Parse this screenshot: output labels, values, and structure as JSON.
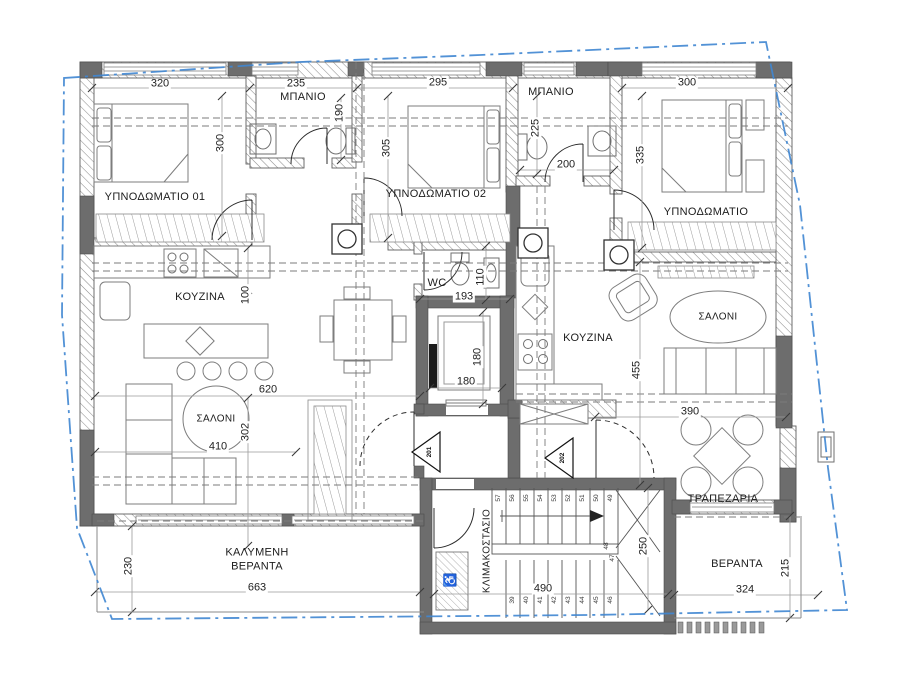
{
  "plan": {
    "rooms": {
      "bedroom1": {
        "label": "ΥΠΝΟΔΩΜΑΤΙΟ 01"
      },
      "bath1": {
        "label": "ΜΠΑΝΙΟ"
      },
      "bedroom2": {
        "label": "ΥΠΝΟΔΩΜΑΤΙΟ 02"
      },
      "bath2": {
        "label": "ΜΠΑΝΙΟ"
      },
      "bedroom3": {
        "label": "ΥΠΝΟΔΩΜΑΤΙΟ"
      },
      "kitchen1": {
        "label": "ΚΟΥΖΙΝΑ"
      },
      "wc": {
        "label": "WC"
      },
      "kitchen2": {
        "label": "ΚΟΥΖΙΝΑ"
      },
      "living1": {
        "label": "ΣΑΛΟΝΙ"
      },
      "living2": {
        "label": "ΣΑΛΟΝΙ"
      },
      "dining": {
        "label": "ΤΡΑΠΕΖΑΡΙΑ"
      },
      "stairs": {
        "label": "ΚΛΙΜΑΚΟΣΤΑΣΙΟ"
      },
      "covered_veranda": {
        "label_line1": "ΚΑΛΥΜΕΝΗ",
        "label_line2": "ΒΕΡΑΝΤΑ"
      },
      "veranda": {
        "label": "ΒΕΡΑΝΤΑ"
      }
    },
    "dimensions": {
      "bedroom1_w": "320",
      "bath1_w": "235",
      "bedroom2_w": "295",
      "bedroom3_w": "300",
      "bedroom1_h": "300",
      "bath1_d": "190",
      "bedroom2_h": "305",
      "bath2_d": "225",
      "bath2_w": "200",
      "bedroom3_h": "335",
      "kitchen1_d": "100",
      "wc_w": "193",
      "wc_d": "110",
      "lift_w": "180",
      "lift_h": "180",
      "kitchen2_h": "455",
      "living1_w": "620",
      "living1_h": "302",
      "sofa_w": "410",
      "living2_w": "390",
      "stairs_w": "490",
      "stairs_h": "250",
      "covered_veranda_w": "663",
      "covered_veranda_h": "230",
      "veranda_w": "324",
      "veranda_h": "215"
    },
    "doors": {
      "apt1": "201",
      "apt2": "202"
    },
    "stairs": {
      "steps_top": [
        "57",
        "56",
        "55",
        "54",
        "53",
        "52",
        "51",
        "50",
        "49"
      ],
      "steps_bottom": [
        "39",
        "40",
        "41",
        "42",
        "43",
        "44",
        "45",
        "46"
      ],
      "steps_landing": [
        "48",
        "47"
      ]
    },
    "icons": {
      "accessible": "♿"
    },
    "colors": {
      "wall": "#6d6d6d",
      "boundary": "#3f86d2",
      "line": "#666666"
    }
  }
}
